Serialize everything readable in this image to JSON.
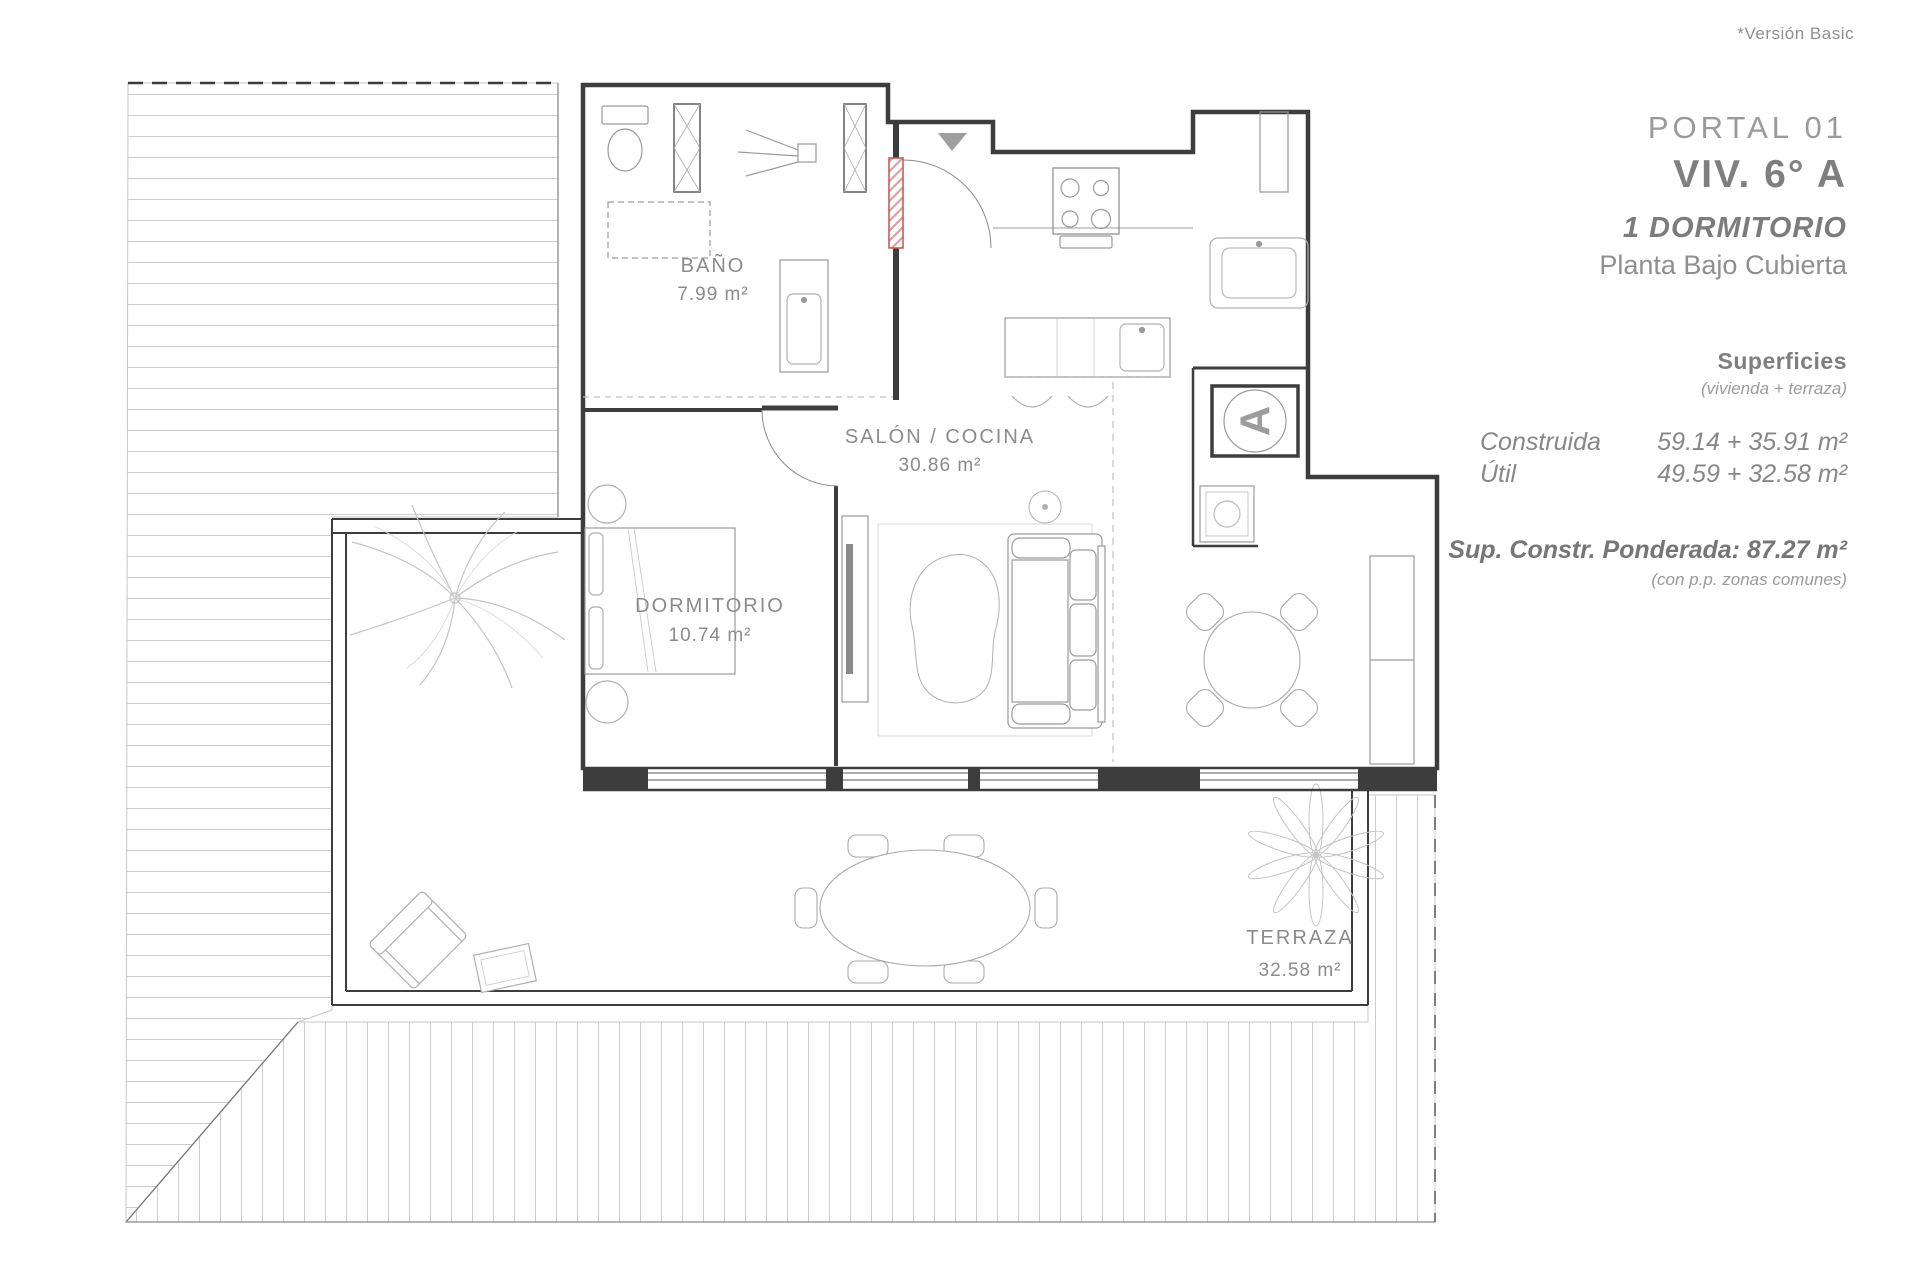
{
  "header": {
    "version_note": "*Versión Basic"
  },
  "info_panel": {
    "portal": "PORTAL 01",
    "unit": "VIV. 6° A",
    "type": "1 DORMITORIO",
    "floor": "Planta Bajo Cubierta",
    "surfaces": {
      "title": "Superficies",
      "subtitle": "(vivienda + terraza)",
      "rows": [
        {
          "label": "Construida",
          "value": "59.14 + 35.91 m²"
        },
        {
          "label": "Útil",
          "value": "49.59 + 32.58 m²"
        }
      ],
      "weighted": "Sup. Constr. Ponderada: 87.27 m²",
      "weighted_note": "(con p.p. zonas comunes)"
    }
  },
  "floor_plan": {
    "rooms": [
      {
        "name": "BAÑO",
        "area": "7.99 m²"
      },
      {
        "name": "SALÓN / COCINA",
        "area": "30.86 m²"
      },
      {
        "name": "DORMITORIO",
        "area": "10.74 m²"
      },
      {
        "name": "TERRAZA",
        "area": "32.58 m²"
      }
    ],
    "unit_marker": "A",
    "colors": {
      "wall": "#3d3d3d",
      "furniture_line": "#a8a8a8",
      "hatch_line": "#cdcdcd",
      "entrance_door": "#c2544f",
      "label_text": "#8b8b8b",
      "marker": "#9c9c9c"
    }
  }
}
